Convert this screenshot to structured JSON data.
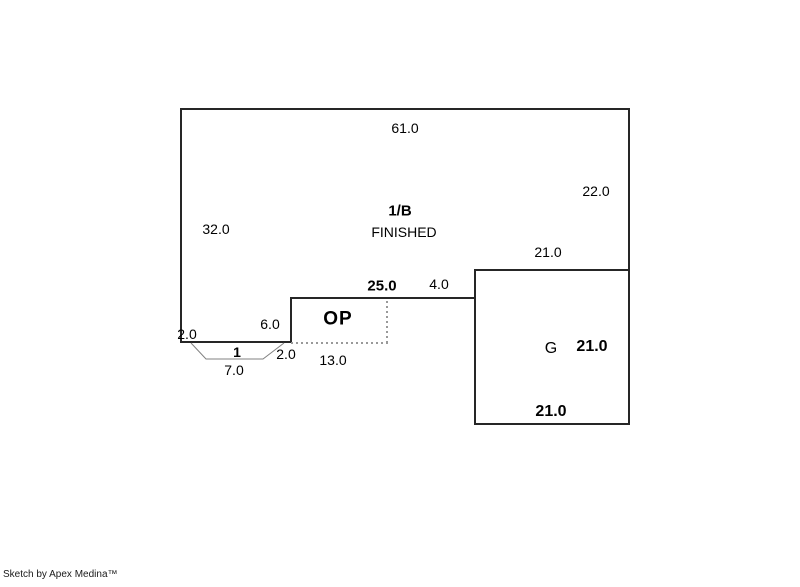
{
  "canvas": {
    "width": 800,
    "height": 587,
    "background": "#ffffff"
  },
  "colors": {
    "outline": "#262626",
    "dashed": "#999999",
    "bay_line": "#808080",
    "text": "#000000"
  },
  "areas": {
    "main": {
      "label": "1/B",
      "status": "FINISHED"
    },
    "porch": {
      "label": "OP"
    },
    "garage": {
      "label": "G"
    },
    "bay": {
      "label": "1"
    }
  },
  "dimensions": {
    "main_top": "61.0",
    "main_right": "22.0",
    "main_left": "32.0",
    "main_left_step": "2.0",
    "porch_span": "25.0",
    "porch_left": "6.0",
    "porch_bottom": "13.0",
    "garage_jog": "4.0",
    "garage_top": "21.0",
    "garage_side": "21.0",
    "garage_bottom": "21.0",
    "bay_right": "2.0",
    "bay_width": "7.0"
  },
  "footer": {
    "credit": "Sketch by Apex Medina™"
  }
}
